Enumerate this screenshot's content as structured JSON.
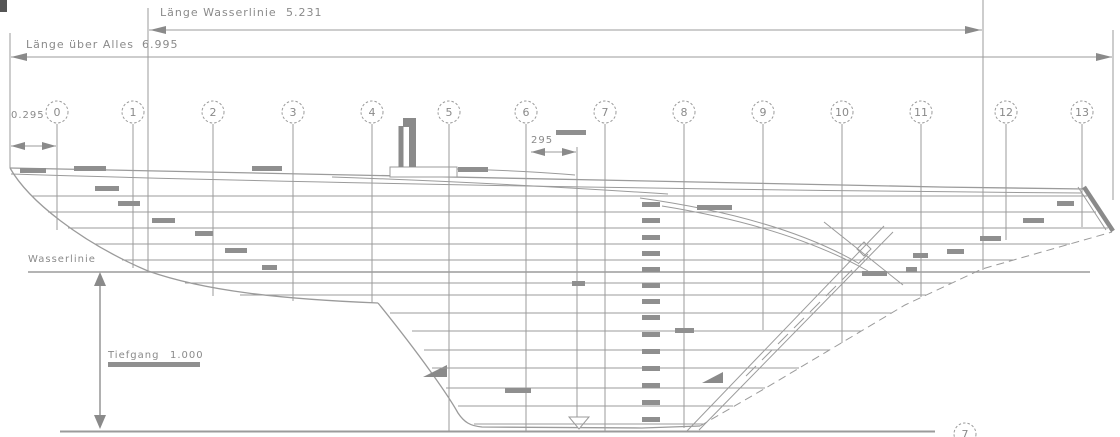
{
  "drawing": {
    "title_hint": "Linienriss Segelboot Seitenansicht",
    "dim_waterline_label": "Länge Wasserlinie",
    "dim_waterline_value": "5.231",
    "dim_loa_label": "Länge über Alles",
    "dim_loa_value": "6.995",
    "dim_bow_value": "0.295",
    "dim_mast_value": "295",
    "waterline_label": "Wasserlinie",
    "draft_label": "Tiefgang",
    "draft_value": "1.000",
    "stations": [
      "0",
      "1",
      "2",
      "3",
      "4",
      "5",
      "6",
      "7",
      "8",
      "9",
      "10",
      "11",
      "12",
      "13"
    ],
    "partial_station_label": "7",
    "colors": {
      "line": "#9b9b9b",
      "dark_line": "#8a8a8a",
      "text": "#8a8a8a",
      "dash_mark": "#8f8f8f",
      "background": "#ffffff",
      "corner_mark": "#555555"
    }
  }
}
